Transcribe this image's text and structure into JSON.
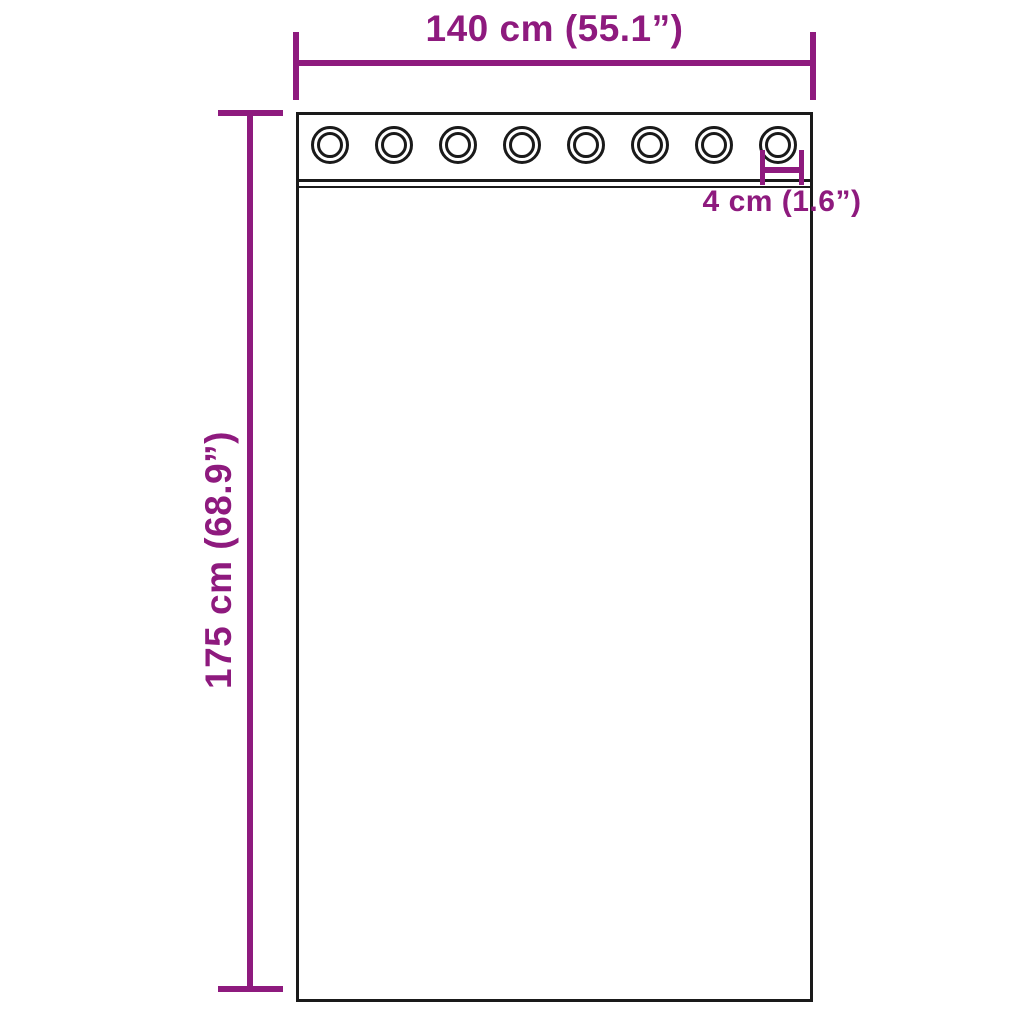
{
  "diagram": {
    "title": "curtain-with-grommets-dimension-diagram",
    "labels": {
      "width": "140 cm (55.1”)",
      "height": "175 cm (68.9”)",
      "grommet": "4 cm (1.6”)"
    },
    "grommet_count": 8,
    "colors": {
      "dimension": "#8e1a7e",
      "outline": "#1a1a1a",
      "background": "#ffffff"
    }
  }
}
